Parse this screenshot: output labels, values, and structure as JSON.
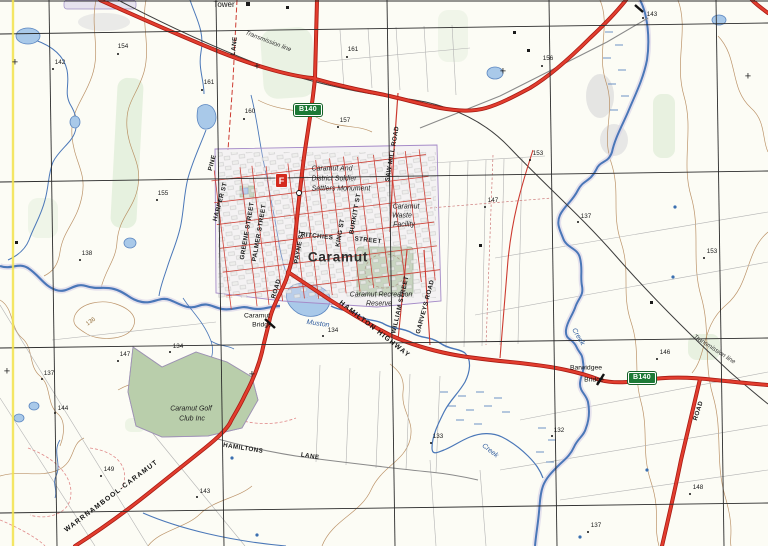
{
  "map_title": "Caramut topographic map extract",
  "colors": {
    "paper": "#fcfcf5",
    "grid": "#2b2b2b",
    "graticule_yellow": "#f2e24a",
    "road_major_fill": "#e23d2e",
    "road_major_casing": "#a81b14",
    "road_minor": "#cc3a30",
    "road_unsealed_gray": "#8a8a8a",
    "water_line": "#4a77b8",
    "water_fill": "#a9c9e9",
    "contour": "#b5885a",
    "vegetation": "#e2eedb",
    "reserve_green": "#bfd3ae",
    "boundary_purple": "#a58bc8",
    "route_badge_green": "#1d7a36",
    "fire_marker_red": "#d42a1e"
  },
  "route_badges": [
    {
      "id": "b140-north",
      "text": "B140",
      "x": 294,
      "y": 104
    },
    {
      "id": "b140-east",
      "text": "B140",
      "x": 628,
      "y": 372
    }
  ],
  "fire_marker": {
    "text": "F",
    "x": 276,
    "y": 174
  },
  "grid_crosses": [
    [
      15,
      63
    ],
    [
      257,
      67
    ],
    [
      503,
      72
    ],
    [
      748,
      77
    ],
    [
      7,
      372
    ],
    [
      252,
      375
    ]
  ],
  "map_labels": [
    {
      "id": "tower",
      "text": "Tower",
      "x": 224,
      "y": 5,
      "rot": 0,
      "cls": "place"
    },
    {
      "id": "transmission-line-nw",
      "text": "Transmission line",
      "x": 268,
      "y": 42,
      "rot": 21,
      "cls": "trans"
    },
    {
      "id": "transmission-line-se",
      "text": "Transmission line",
      "x": 714,
      "y": 350,
      "rot": 33,
      "cls": "trans"
    },
    {
      "id": "lane-north",
      "text": "LANE",
      "x": 235,
      "y": 46,
      "rot": -83,
      "cls": "rd"
    },
    {
      "id": "pine",
      "text": "PINE",
      "x": 213,
      "y": 163,
      "rot": -75,
      "cls": "rd"
    },
    {
      "id": "harper-st",
      "text": "HARPER ST",
      "x": 221,
      "y": 202,
      "rot": -75,
      "cls": "rd"
    },
    {
      "id": "greene-street",
      "text": "GREENE STREET",
      "x": 248,
      "y": 231,
      "rot": -80,
      "cls": "rd"
    },
    {
      "id": "palmer-street",
      "text": "PALMER STREET",
      "x": 260,
      "y": 233,
      "rot": -80,
      "cls": "rd"
    },
    {
      "id": "payne-st",
      "text": "PAYNE ST",
      "x": 300,
      "y": 247,
      "rot": -80,
      "cls": "rd"
    },
    {
      "id": "king-st",
      "text": "KING ST",
      "x": 341,
      "y": 233,
      "rot": -80,
      "cls": "rd"
    },
    {
      "id": "burkitt-st",
      "text": "BURKITT ST",
      "x": 356,
      "y": 214,
      "rot": -80,
      "cls": "rd"
    },
    {
      "id": "ritchies",
      "text": "RITCHIES",
      "x": 317,
      "y": 237,
      "rot": 6,
      "cls": "rd"
    },
    {
      "id": "ritchies-street",
      "text": "STREET",
      "x": 368,
      "y": 241,
      "rot": 6,
      "cls": "rd"
    },
    {
      "id": "saw-mill-road",
      "text": "SAW MILL ROAD",
      "x": 393,
      "y": 154,
      "rot": -80,
      "cls": "rd"
    },
    {
      "id": "william-street",
      "text": "WILLIAM STREET",
      "x": 401,
      "y": 305,
      "rot": -77,
      "cls": "rd"
    },
    {
      "id": "garveys-road",
      "text": "GARVEYS ROAD",
      "x": 426,
      "y": 307,
      "rot": -75,
      "cls": "rd"
    },
    {
      "id": "hamilton-highway",
      "text": "HAMILTON HIGHWAY",
      "x": 374,
      "y": 330,
      "rot": 38,
      "cls": "rd-maj"
    },
    {
      "id": "road-southwest",
      "text": "ROAD",
      "x": 277,
      "y": 289,
      "rot": -73,
      "cls": "rd"
    },
    {
      "id": "road-southeast",
      "text": "ROAD",
      "x": 699,
      "y": 411,
      "rot": -72,
      "cls": "rd"
    },
    {
      "id": "hamiltons",
      "text": "HAMILTONS",
      "x": 243,
      "y": 449,
      "rot": 9,
      "cls": "rd"
    },
    {
      "id": "hamiltons-lane",
      "text": "LANE",
      "x": 310,
      "y": 457,
      "rot": 9,
      "cls": "rd"
    },
    {
      "id": "warrnambool-caramut",
      "text": "WARRNAMBOOL-CARAMUT",
      "x": 112,
      "y": 497,
      "rot": -37,
      "cls": "rd-maj"
    },
    {
      "id": "caramut-town",
      "text": "Caramut",
      "x": 338,
      "y": 257,
      "rot": 0,
      "cls": "town"
    },
    {
      "id": "monument-line1",
      "text": "Caramut And",
      "x": 332,
      "y": 169,
      "rot": 0,
      "cls": "feat"
    },
    {
      "id": "monument-line2",
      "text": "District Soldier",
      "x": 334,
      "y": 179,
      "rot": 0,
      "cls": "feat"
    },
    {
      "id": "monument-line3",
      "text": "Settlers Monument",
      "x": 341,
      "y": 189,
      "rot": 0,
      "cls": "feat"
    },
    {
      "id": "waste-line1",
      "text": "Caramut",
      "x": 406,
      "y": 207,
      "rot": 0,
      "cls": "feat"
    },
    {
      "id": "waste-line2",
      "text": "Waste",
      "x": 402,
      "y": 216,
      "rot": 0,
      "cls": "feat"
    },
    {
      "id": "waste-line3",
      "text": "Facility",
      "x": 404,
      "y": 225,
      "rot": 0,
      "cls": "feat"
    },
    {
      "id": "recreation-line1",
      "text": "Caramut Recreation",
      "x": 381,
      "y": 295,
      "rot": 0,
      "cls": "feat"
    },
    {
      "id": "recreation-line2",
      "text": "Reserve",
      "x": 379,
      "y": 304,
      "rot": 0,
      "cls": "feat"
    },
    {
      "id": "golf-line1",
      "text": "Caramut Golf",
      "x": 191,
      "y": 409,
      "rot": 0,
      "cls": "feat"
    },
    {
      "id": "golf-line2",
      "text": "Club Inc",
      "x": 192,
      "y": 419,
      "rot": 0,
      "cls": "feat"
    },
    {
      "id": "caramut-bridge-line1",
      "text": "Caramut",
      "x": 257,
      "y": 317,
      "rot": 0,
      "cls": "bridge"
    },
    {
      "id": "caramut-bridge-line2",
      "text": "Bridge",
      "x": 262,
      "y": 326,
      "rot": 0,
      "cls": "bridge"
    },
    {
      "id": "barwidgee-line1",
      "text": "Barwidgee",
      "x": 586,
      "y": 369,
      "rot": 0,
      "cls": "bridge"
    },
    {
      "id": "barwidgee-line2",
      "text": "Bridge",
      "x": 594,
      "y": 381,
      "rot": 0,
      "cls": "bridge"
    },
    {
      "id": "muston",
      "text": "Muston",
      "x": 318,
      "y": 324,
      "rot": 8,
      "cls": "water"
    },
    {
      "id": "creek-northeast",
      "text": "Creek",
      "x": 578,
      "y": 337,
      "rot": 60,
      "cls": "water"
    },
    {
      "id": "creek-south",
      "text": "Creek",
      "x": 490,
      "y": 451,
      "rot": 38,
      "cls": "water"
    },
    {
      "id": "contour-136",
      "text": "136",
      "x": 91,
      "y": 322,
      "rot": -35,
      "cls": "contour-lbl"
    }
  ],
  "spot_heights": [
    {
      "value": "154",
      "tx": 123,
      "ty": 47,
      "dx": 118,
      "dy": 54
    },
    {
      "value": "142",
      "tx": 60,
      "ty": 63,
      "dx": 53,
      "dy": 69
    },
    {
      "value": "161",
      "tx": 353,
      "ty": 50,
      "dx": 347,
      "dy": 57
    },
    {
      "value": "161",
      "tx": 209,
      "ty": 83,
      "dx": 202,
      "dy": 90
    },
    {
      "value": "160",
      "tx": 250,
      "ty": 112,
      "dx": 244,
      "dy": 119
    },
    {
      "value": "157",
      "tx": 345,
      "ty": 121,
      "dx": 338,
      "dy": 127
    },
    {
      "value": "156",
      "tx": 548,
      "ty": 59,
      "dx": 542,
      "dy": 66
    },
    {
      "value": "143",
      "tx": 652,
      "ty": 15,
      "dx": 643,
      "dy": 18
    },
    {
      "value": "153",
      "tx": 538,
      "ty": 154,
      "dx": 530,
      "dy": 160
    },
    {
      "value": "147",
      "tx": 493,
      "ty": 201,
      "dx": 485,
      "dy": 207
    },
    {
      "value": "137",
      "tx": 586,
      "ty": 217,
      "dx": 578,
      "dy": 222
    },
    {
      "value": "153",
      "tx": 712,
      "ty": 252,
      "dx": 704,
      "dy": 258
    },
    {
      "value": "155",
      "tx": 163,
      "ty": 194,
      "dx": 157,
      "dy": 200
    },
    {
      "value": "138",
      "tx": 87,
      "ty": 254,
      "dx": 80,
      "dy": 260
    },
    {
      "value": "147",
      "tx": 125,
      "ty": 355,
      "dx": 118,
      "dy": 361
    },
    {
      "value": "137",
      "tx": 49,
      "ty": 374,
      "dx": 42,
      "dy": 379
    },
    {
      "value": "144",
      "tx": 63,
      "ty": 409,
      "dx": 55,
      "dy": 413
    },
    {
      "value": "134",
      "tx": 178,
      "ty": 347,
      "dx": 170,
      "dy": 352
    },
    {
      "value": "134",
      "tx": 333,
      "ty": 331,
      "dx": 323,
      "dy": 336
    },
    {
      "value": "146",
      "tx": 665,
      "ty": 353,
      "dx": 657,
      "dy": 359
    },
    {
      "value": "132",
      "tx": 559,
      "ty": 431,
      "dx": 552,
      "dy": 436
    },
    {
      "value": "133",
      "tx": 438,
      "ty": 437,
      "dx": 431,
      "dy": 443
    },
    {
      "value": "148",
      "tx": 698,
      "ty": 488,
      "dx": 690,
      "dy": 494
    },
    {
      "value": "137",
      "tx": 596,
      "ty": 526,
      "dx": 588,
      "dy": 532
    },
    {
      "value": "143",
      "tx": 205,
      "ty": 492,
      "dx": 197,
      "dy": 497
    },
    {
      "value": "149",
      "tx": 109,
      "ty": 470,
      "dx": 101,
      "dy": 476
    }
  ]
}
